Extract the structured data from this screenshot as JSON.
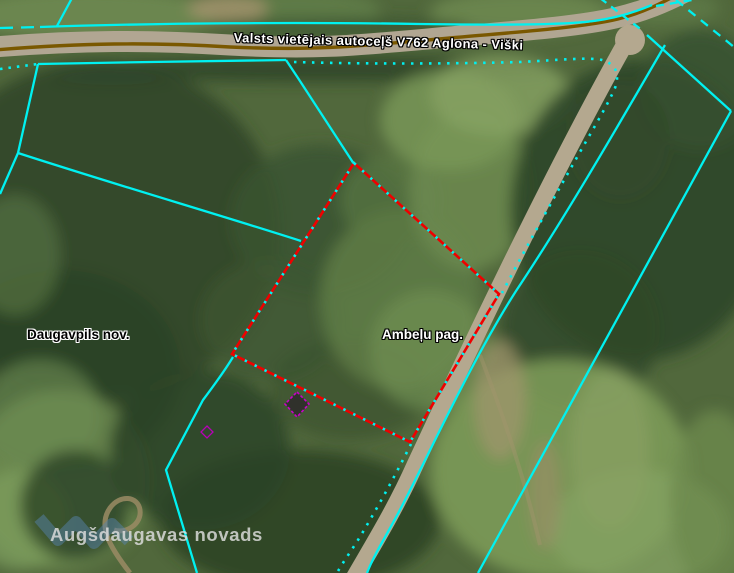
{
  "map": {
    "road_label": "Valsts vietējais autoceļš V762 Aglona - Viški",
    "area_labels": {
      "municipality": "Daugavpils nov.",
      "parish": "Ambeļu pag."
    },
    "watermark_text": "Augšdaugavas novads",
    "colors": {
      "admin_boundary": "#00f1f1",
      "parcel_boundary": "#ef0000",
      "road_centerline": "#7a5800",
      "road_surface": "#b1a692",
      "building_marker": "#c800c8",
      "watermark_logo": "#5582aa"
    }
  }
}
